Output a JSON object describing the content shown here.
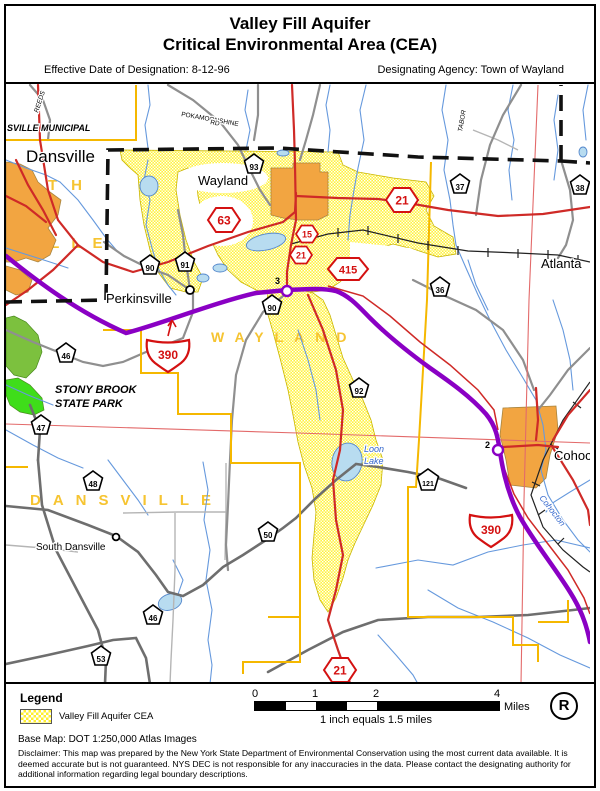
{
  "header": {
    "title_line1": "Valley Fill Aquifer",
    "title_line2": "Critical Environmental Area (CEA)",
    "effective_date": "Effective Date of Designation: 8-12-96",
    "agency": "Designating Agency: Town of Wayland"
  },
  "legend": {
    "heading": "Legend",
    "aquifer_item": "Valley Fill Aquifer CEA",
    "base_map": "Base Map: DOT 1:250,000 Atlas Images",
    "disclaimer": "Disclaimer: This map was prepared by the New York State Department of Environmental Conservation using the most current data available. It is deemed accurate but is not guaranteed. NYS DEC is not responsible for any inaccuracies in the data.  Please contact the designating authority for additional information regarding legal boundary descriptions.",
    "registered_symbol": "R"
  },
  "scalebar": {
    "tick0": "0",
    "tick1": "1",
    "tick2": "2",
    "tick4": "4",
    "unit": "Miles",
    "caption": "1 inch equals 1.5 miles"
  },
  "map": {
    "labels": {
      "dansville": "Dansville",
      "wayland": "Wayland",
      "perkinsville": "Perkinsville",
      "atlanta": "Atlanta",
      "cohocton_village": "Cohocton",
      "south_dansville": "South Dansville",
      "municipal": "SVILLE MUNICIPAL",
      "pokamoonshine": "POKAMOONSHINE",
      "pokamoonshine_rd": "RD",
      "tabor": "TABOR",
      "reeds": "REEDS",
      "stony_brook_1": "STONY BROOK",
      "stony_brook_2": "STATE PARK",
      "loon_1": "Loon",
      "loon_2": "Lake",
      "cohocton_river": "Cohocton",
      "town_wayland": "WAYLAND",
      "town_dansville": "DANSVILLE",
      "town_partial_th": "TH",
      "town_partial_ville": "VILLE"
    },
    "shields": [
      {
        "type": "county-route",
        "label": "93"
      },
      {
        "type": "county-route",
        "label": "90"
      },
      {
        "type": "county-route",
        "label": "91"
      },
      {
        "type": "county-route",
        "label": "90"
      },
      {
        "type": "county-route",
        "label": "37"
      },
      {
        "type": "county-route",
        "label": "38"
      },
      {
        "type": "county-route",
        "label": "36"
      },
      {
        "type": "county-route",
        "label": "92"
      },
      {
        "type": "county-route",
        "label": "46"
      },
      {
        "type": "county-route",
        "label": "47"
      },
      {
        "type": "county-route",
        "label": "48"
      },
      {
        "type": "county-route",
        "label": "50"
      },
      {
        "type": "county-route",
        "label": "46"
      },
      {
        "type": "county-route",
        "label": "53"
      },
      {
        "type": "county-route",
        "label": "121"
      },
      {
        "type": "state-route",
        "label": "63"
      },
      {
        "type": "state-route",
        "label": "15"
      },
      {
        "type": "state-route",
        "label": "21"
      },
      {
        "type": "state-route",
        "label": "21"
      },
      {
        "type": "state-route",
        "label": "415"
      },
      {
        "type": "state-route",
        "label": "21"
      },
      {
        "type": "interstate",
        "label": "390"
      },
      {
        "type": "interstate",
        "label": "390"
      }
    ],
    "exits": [
      {
        "label": "3"
      },
      {
        "label": "2"
      }
    ],
    "colors": {
      "aquifer_yellow": "#fff23d",
      "urban_orange": "#f2a541",
      "park_green": "#7cc13e",
      "park_green_bright": "#3fdd1a",
      "highway_purple": "#8a00c4",
      "road_red": "#cf2a27",
      "boundary_yellow": "#f5b800",
      "grid_red": "#e36a6a",
      "water_blue": "#6699dd",
      "town_label_yellow": "#f6c431"
    }
  }
}
